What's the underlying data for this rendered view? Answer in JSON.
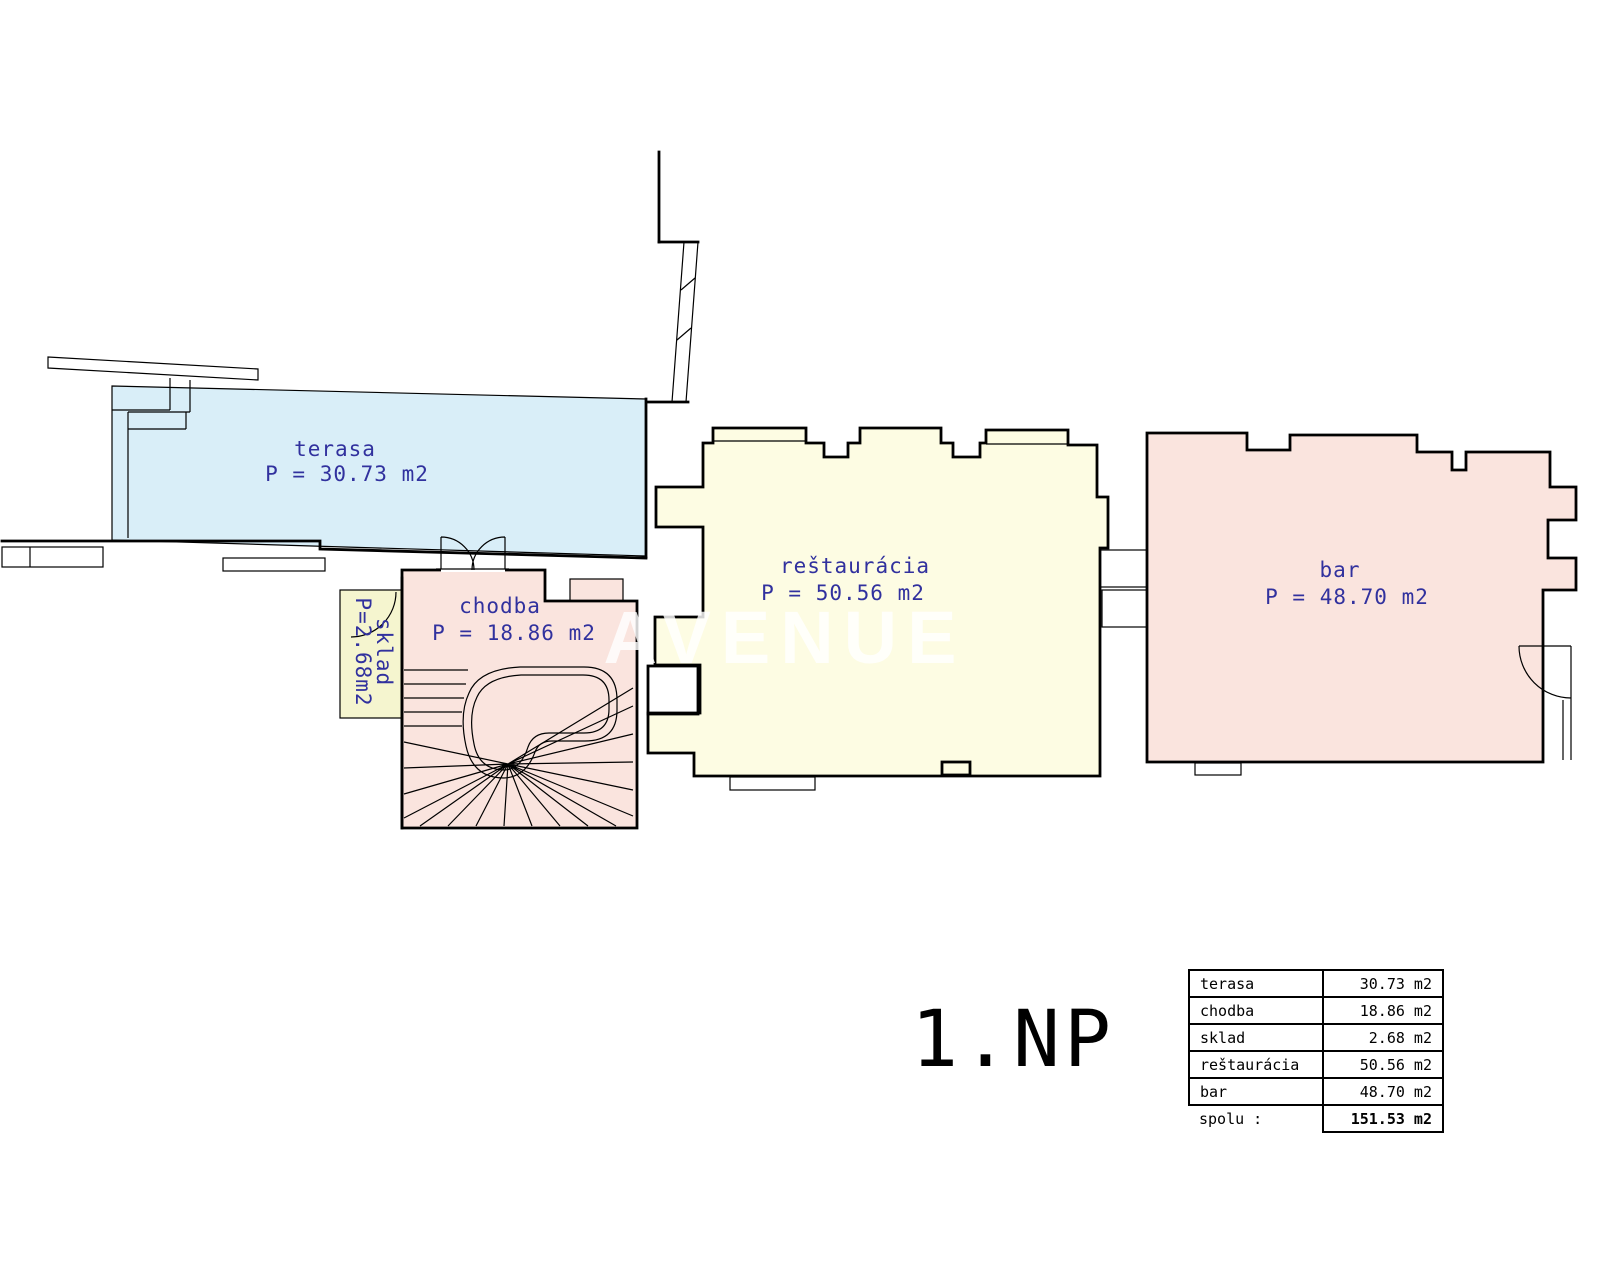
{
  "floorplan": {
    "title": "1.NP",
    "watermark": "AVENUE",
    "label_color": "#31319e",
    "wall_color": "#000000",
    "rooms": {
      "terasa": {
        "name": "terasa",
        "area": "P = 30.73 m2",
        "fill": "#d9eef8"
      },
      "chodba": {
        "name": "chodba",
        "area": "P = 18.86 m2",
        "fill": "#fae4de"
      },
      "sklad": {
        "name": "sklad",
        "area": "P=2.68m2",
        "fill": "#f5f5cf"
      },
      "restauracia": {
        "name": "reštaurácia",
        "area": "P = 50.56 m2",
        "fill": "#fdfce3"
      },
      "bar": {
        "name": "bar",
        "area": "P = 48.70 m2",
        "fill": "#fae4de"
      }
    },
    "table": {
      "rows": [
        {
          "label": "terasa",
          "value": "30.73 m2"
        },
        {
          "label": "chodba",
          "value": "18.86 m2"
        },
        {
          "label": "sklad",
          "value": "2.68 m2"
        },
        {
          "label": "reštaurácia",
          "value": "50.56 m2"
        },
        {
          "label": "bar",
          "value": "48.70 m2"
        }
      ],
      "total_label": "spolu :",
      "total_value": "151.53 m2"
    }
  }
}
